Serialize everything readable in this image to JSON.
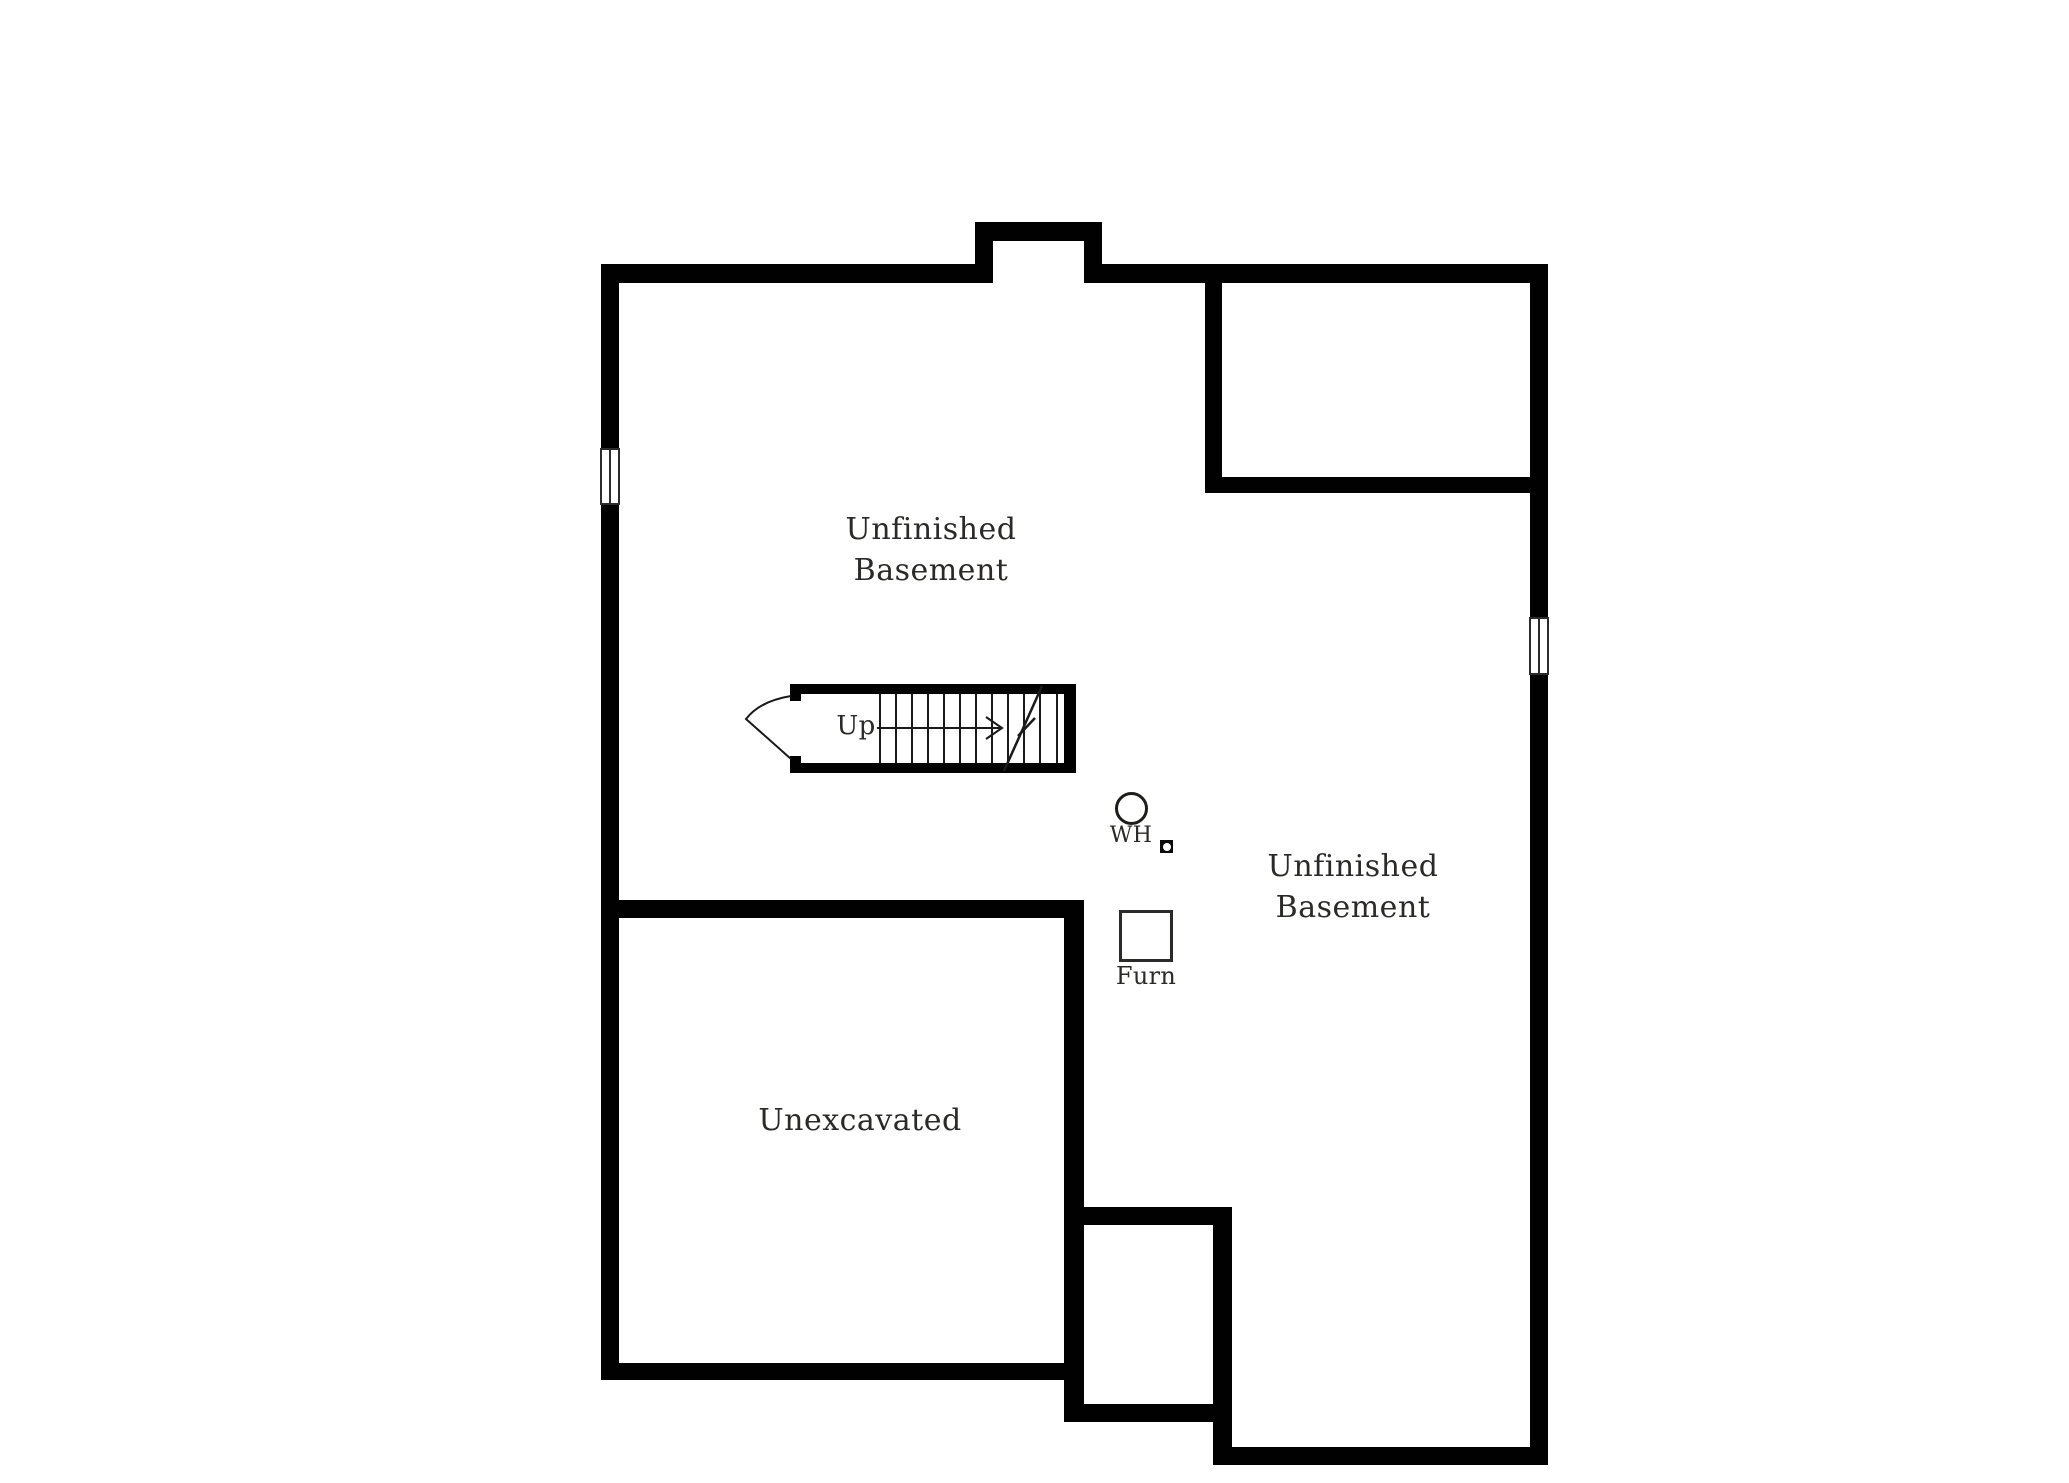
{
  "floorplan": {
    "rooms": {
      "basement_left": {
        "line1": "Unfinished",
        "line2": "Basement"
      },
      "basement_right": {
        "line1": "Unfinished",
        "line2": "Basement"
      },
      "unexcavated": {
        "label": "Unexcavated"
      }
    },
    "stairs": {
      "direction_label": "Up"
    },
    "equipment": {
      "water_heater": {
        "label": "WH",
        "symbol": "circle"
      },
      "furnace": {
        "label": "Furn",
        "symbol": "square"
      },
      "floor_drain": {
        "symbol": "square-with-circle"
      }
    },
    "colors": {
      "wall": "#010101",
      "text": "#2b2a28",
      "line": "#1a1a1a",
      "background": "#ffffff"
    }
  }
}
